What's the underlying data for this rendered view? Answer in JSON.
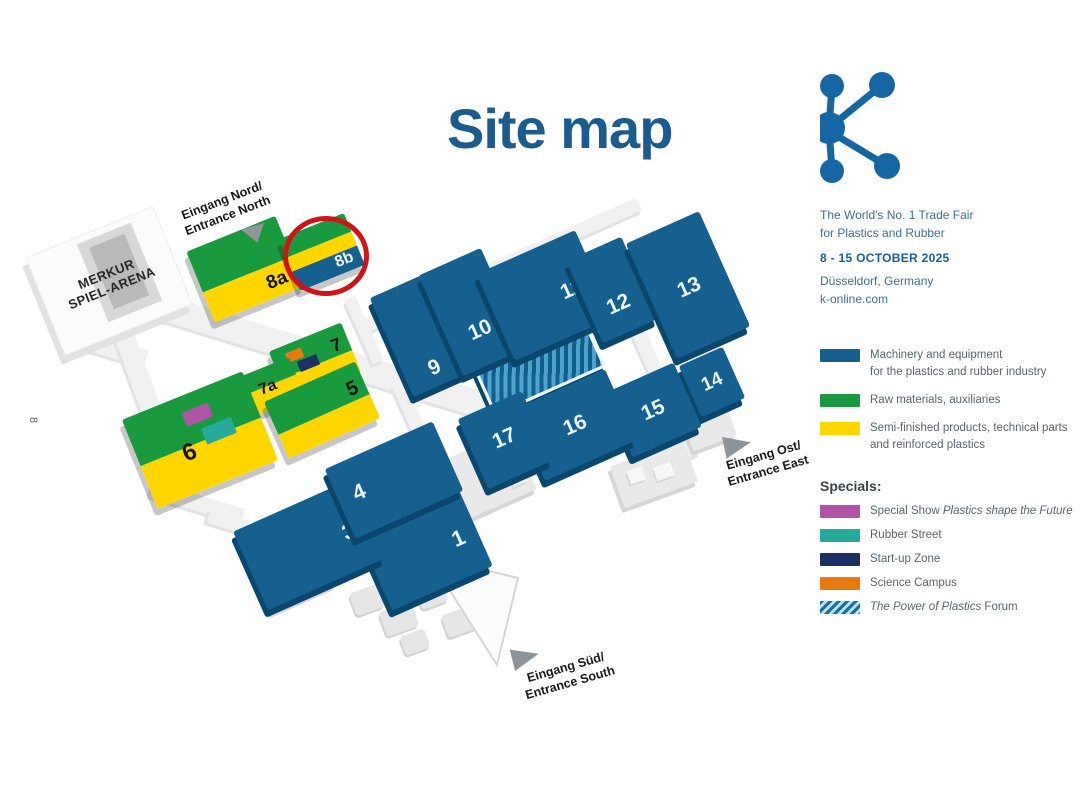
{
  "title": "Site map",
  "brand": {
    "tagline1": "The World's No. 1 Trade Fair",
    "tagline2": "for Plastics and Rubber",
    "dates": "8 - 15 OCTOBER 2025",
    "location": "Düsseldorf, Germany",
    "website": "k-online.com",
    "logo": "k-logo",
    "logo_color": "#1566a3"
  },
  "legend": {
    "items": [
      {
        "color": "#15608e",
        "line1": "Machinery and equipment",
        "line2": "for the plastics and rubber industry"
      },
      {
        "color": "#1a9a3e",
        "line1": "Raw materials, auxiliaries",
        "line2": ""
      },
      {
        "color": "#ffd600",
        "line1": "Semi-finished products, technical parts",
        "line2": "and reinforced plastics"
      }
    ],
    "specials_heading": "Specials:",
    "specials": [
      {
        "color": "#b054a8",
        "prefix": "Special Show ",
        "italic": "Plastics shape the Future",
        "suffix": ""
      },
      {
        "color": "#27a99c",
        "prefix": "Rubber Street",
        "italic": "",
        "suffix": ""
      },
      {
        "color": "#1d3066",
        "prefix": "Start-up Zone",
        "italic": "",
        "suffix": ""
      },
      {
        "color": "#e87a12",
        "prefix": "Science Campus",
        "italic": "",
        "suffix": ""
      },
      {
        "color": "#1b6fa8",
        "pattern": "diagonal-stripes",
        "prefix": "",
        "italic": "The Power of Plastics",
        "suffix": " Forum"
      }
    ]
  },
  "map": {
    "arena": {
      "line1": "MERKUR",
      "line2": "SPIEL-ARENA"
    },
    "entrances": {
      "north": {
        "line1": "Eingang Nord/",
        "line2": "Entrance North"
      },
      "east": {
        "line1": "Eingang Ost/",
        "line2": "Entrance East"
      },
      "south": {
        "line1": "Eingang Süd/",
        "line2": "Entrance South"
      }
    },
    "halls": [
      {
        "id": "hall-1",
        "label": "1",
        "category": "machinery"
      },
      {
        "id": "hall-3",
        "label": "3",
        "category": "machinery"
      },
      {
        "id": "hall-4",
        "label": "4",
        "category": "machinery"
      },
      {
        "id": "hall-5",
        "label": "5",
        "category": "raw-and-semi"
      },
      {
        "id": "hall-6",
        "label": "6",
        "category": "raw-and-semi"
      },
      {
        "id": "hall-7",
        "label": "7",
        "category": "raw-and-semi"
      },
      {
        "id": "hall-7a",
        "label": "7a",
        "category": "raw-and-semi"
      },
      {
        "id": "hall-8a",
        "label": "8a",
        "category": "raw-and-semi"
      },
      {
        "id": "hall-8b",
        "label": "8b",
        "category": "raw-semi-machinery",
        "highlighted": true
      },
      {
        "id": "hall-9",
        "label": "9",
        "category": "machinery"
      },
      {
        "id": "hall-10",
        "label": "10",
        "category": "machinery"
      },
      {
        "id": "hall-11",
        "label": "11",
        "category": "machinery"
      },
      {
        "id": "hall-12",
        "label": "12",
        "category": "machinery"
      },
      {
        "id": "hall-13",
        "label": "13",
        "category": "machinery"
      },
      {
        "id": "hall-14",
        "label": "14",
        "category": "machinery"
      },
      {
        "id": "hall-15",
        "label": "15",
        "category": "machinery"
      },
      {
        "id": "hall-16",
        "label": "16",
        "category": "machinery"
      },
      {
        "id": "hall-17",
        "label": "17",
        "category": "machinery"
      }
    ],
    "highlight": {
      "hall": "8b",
      "marker": "red-circle",
      "color": "#cf1317"
    },
    "forum_area": "The Power of Plastics Forum",
    "page_marker": "8",
    "colors": {
      "machinery_blue": "#15608e",
      "raw_materials_green": "#1a9a3e",
      "semi_finished_yellow": "#ffd600",
      "special_show_magenta": "#b054a8",
      "rubber_street_teal": "#27a99c",
      "startup_zone_navy": "#1d3066",
      "science_campus_orange": "#e87a12",
      "title_blue": "#1a5c90"
    }
  }
}
